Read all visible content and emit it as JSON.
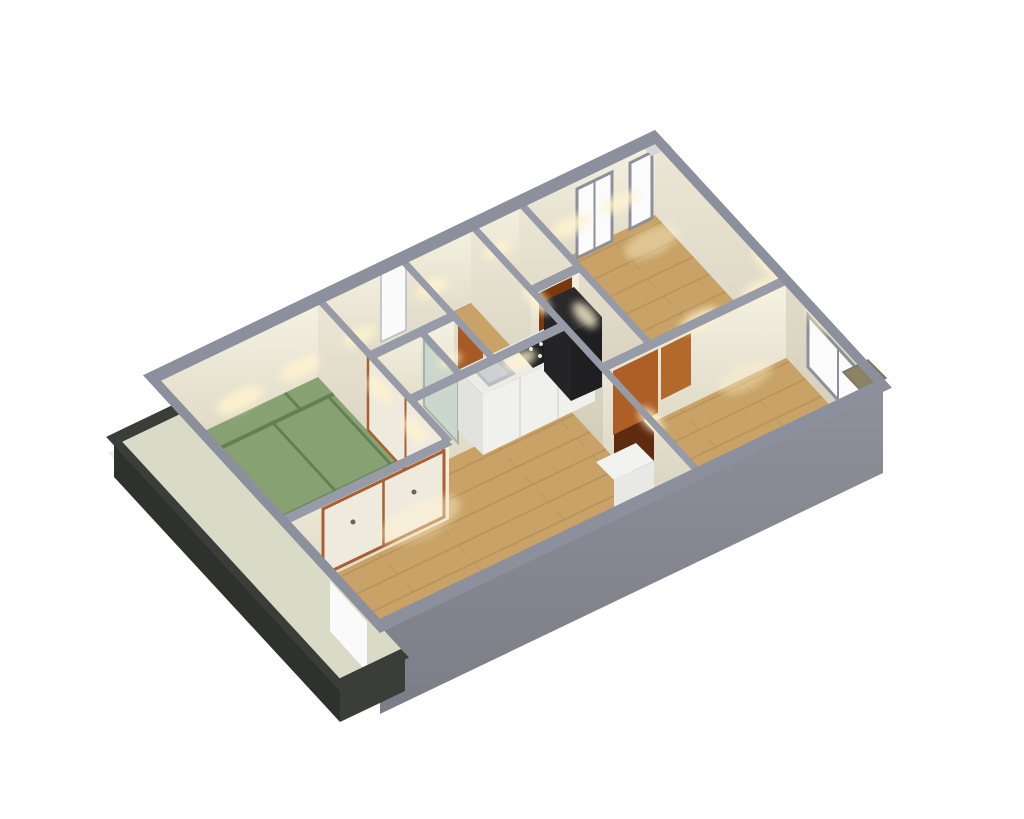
{
  "scene": {
    "type": "3d-floorplan-axonometric-render",
    "background": "#ffffff",
    "view": "isometric-from-south-west-above",
    "building_outline": "parallelogram",
    "no_visible_text": true
  },
  "colors": {
    "background": "#ffffff",
    "wall_line": "#979aa7",
    "wall_line_outer": "#8c8f9c",
    "face_n_top": "#f6f2e3",
    "face_n_bottom": "#dcd7c2",
    "face_e_top": "#ece7d6",
    "face_e_bottom": "#d2cdb8",
    "ext_top": "#90909a",
    "ext_bottom": "#7d7d87",
    "wood": "#c8a266",
    "wood_seam": "#8a6a38",
    "tatami": "#87a173",
    "tatami_line": "#647f52",
    "tatami_border": "#70885f",
    "khaki": "#7d7767",
    "bath": "#dde2dd",
    "glass": "#c9d6cd",
    "glass_frame": "#9fb0a6",
    "genkan_tile": "#8b8578",
    "balcony_floor": "#d9dbc7",
    "balcony_rail": "#3a3d38",
    "balcony_rail_dark": "#2e312c",
    "balcony_slab": "#edeff1",
    "white_opening": "#fafafb",
    "opening_edge": "#b9bac4",
    "door_orange": "#ad5f26",
    "door_orange_light": "#b3682c",
    "door_dark": "#5e2b10",
    "door_brown": "#79380e",
    "trim_brown": "#a86030",
    "closet_door": "#efeade",
    "closet_handle": "#6b6257",
    "counter_top": "#ebebe7",
    "counter_face": "#f0f0ec",
    "counter_side": "#e2e2de",
    "sink_outer": "#b9bdbf",
    "sink_inner": "#cdd1d3",
    "cooktop": "#1b1b1d",
    "burner_dot": "#e8e8e8",
    "hood_top": "#2a2a2c",
    "hood_front": "#1f1f21",
    "hood_side": "#242426",
    "cabinet_orange": "#a85a26",
    "fridge_top": "#f2f2ef",
    "fridge_front": "#e8e8e4",
    "window_white": "#fbfbfb",
    "window_frame": "#8e8f9a",
    "light_pool": "#fff4cf",
    "ac_pad": "#8a8263",
    "ac_pad_edge": "#74746c",
    "corner_cap": "#d6d6da"
  },
  "rooms": [
    {
      "id": "tatami-room",
      "floor": "tatami",
      "features": [
        "6-mat-tatami-layout",
        "fusuma-sliding-door-east",
        "closet-south"
      ]
    },
    {
      "id": "living-dining",
      "floor": "wood",
      "features": [
        "open-kitchen",
        "balcony-opening-west",
        "sliding-closet-north"
      ]
    },
    {
      "id": "kitchen",
      "floor": "wood",
      "features": [
        "counter",
        "sink",
        "cooktop",
        "range-hood",
        "tall-cabinet",
        "refrigerator"
      ]
    },
    {
      "id": "washroom",
      "floor": "khaki",
      "features": []
    },
    {
      "id": "bathroom",
      "floor": "bath",
      "features": [
        "glass-door"
      ]
    },
    {
      "id": "entrance-hall",
      "floor": "wood",
      "features": [
        "genkan-tile",
        "front-door-opening"
      ]
    },
    {
      "id": "toilet",
      "floor": "khaki",
      "features": [
        "brown-door"
      ]
    },
    {
      "id": "bedroom-north",
      "floor": "wood",
      "features": [
        "window-north-1",
        "window-north-2"
      ]
    },
    {
      "id": "bedroom-south",
      "floor": "wood",
      "features": [
        "window-east",
        "dark-entry-door",
        "orange-closet-doors"
      ]
    },
    {
      "id": "balcony",
      "floor": "balcony_floor",
      "features": [
        "dark-railing",
        "white-slab-base"
      ]
    }
  ],
  "openings": {
    "windows": [
      {
        "id": "window-north-1",
        "wall": "north",
        "panes": 2
      },
      {
        "id": "window-north-2",
        "wall": "north-corner",
        "panes": 1
      },
      {
        "id": "window-east",
        "wall": "east",
        "panes": 2
      }
    ],
    "doors": [
      {
        "id": "front-door-opening",
        "style": "white-gap"
      },
      {
        "id": "balcony-opening",
        "style": "white-gap"
      },
      {
        "id": "fusuma-tatami-east",
        "style": "cream-sliding-brown-trim"
      },
      {
        "id": "closet-living-north",
        "style": "white-sliding-brown-trim"
      },
      {
        "id": "door-hall-kitchen",
        "style": "orange-panel"
      },
      {
        "id": "door-toilet",
        "style": "dark-brown-open"
      },
      {
        "id": "door-bedroom-south",
        "style": "dark-brown"
      },
      {
        "id": "closet-bedroom-south-1",
        "style": "orange-panel"
      },
      {
        "id": "closet-bedroom-south-2",
        "style": "orange-panel-light"
      },
      {
        "id": "door-bathroom",
        "style": "frosted-glass"
      }
    ]
  },
  "exterior": {
    "south_face": "gray-extruded-wall",
    "balcony_position": "south-west",
    "ac_pad": "khaki-square-at-east-corner",
    "corner_cap": "light-gray-cap-at-north-corner"
  }
}
